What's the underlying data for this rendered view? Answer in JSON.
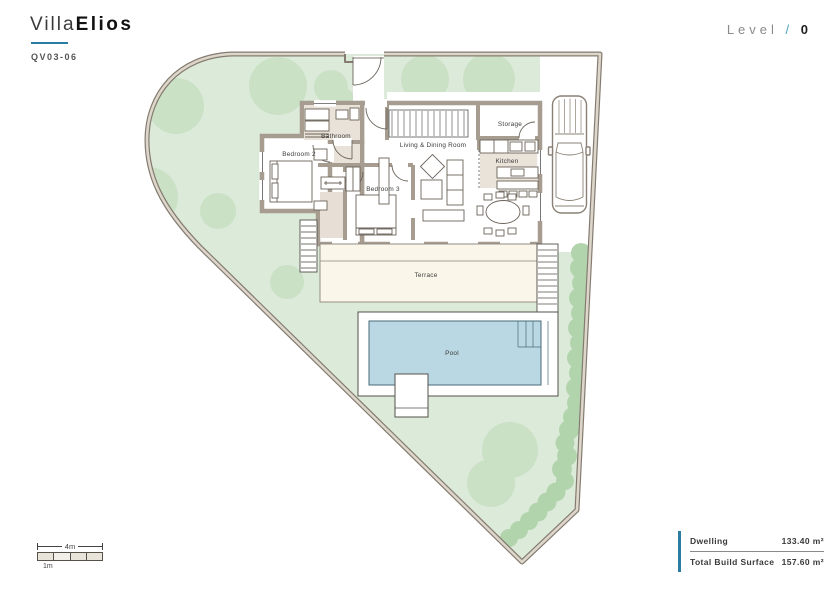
{
  "header": {
    "brand_light": "Villa",
    "brand_bold": "Elios",
    "reference": "QV03-06",
    "level_label": "Level",
    "level_separator": "/",
    "level_value": "0"
  },
  "plan": {
    "rooms": {
      "bathroom": "Bathroom",
      "bedroom2": "Bedroom 2",
      "bedroom3": "Bedroom 3",
      "living": "Living & Dining Room",
      "storage": "Storage",
      "kitchen": "Kitchen",
      "terrace": "Terrace",
      "pool": "Pool"
    }
  },
  "scale_bar": {
    "total_label": "4m",
    "unit_label": "1m"
  },
  "summary": {
    "rows": [
      {
        "label": "Dwelling",
        "value": "133.40 m²"
      },
      {
        "label": "Total Build Surface",
        "value": "157.60 m²"
      }
    ]
  },
  "colors": {
    "accent": "#2a7ca3",
    "garden": "#dcead9",
    "tree": "#bcd9b6",
    "hedge": "#b2d4ac",
    "pool_water": "#bad8e3",
    "terrace": "#faf6e9",
    "wall": "#a69c90",
    "boundary": "#857b70",
    "boundary_inner": "#ddd7cb",
    "floor_tint": "#e9e2d8"
  }
}
